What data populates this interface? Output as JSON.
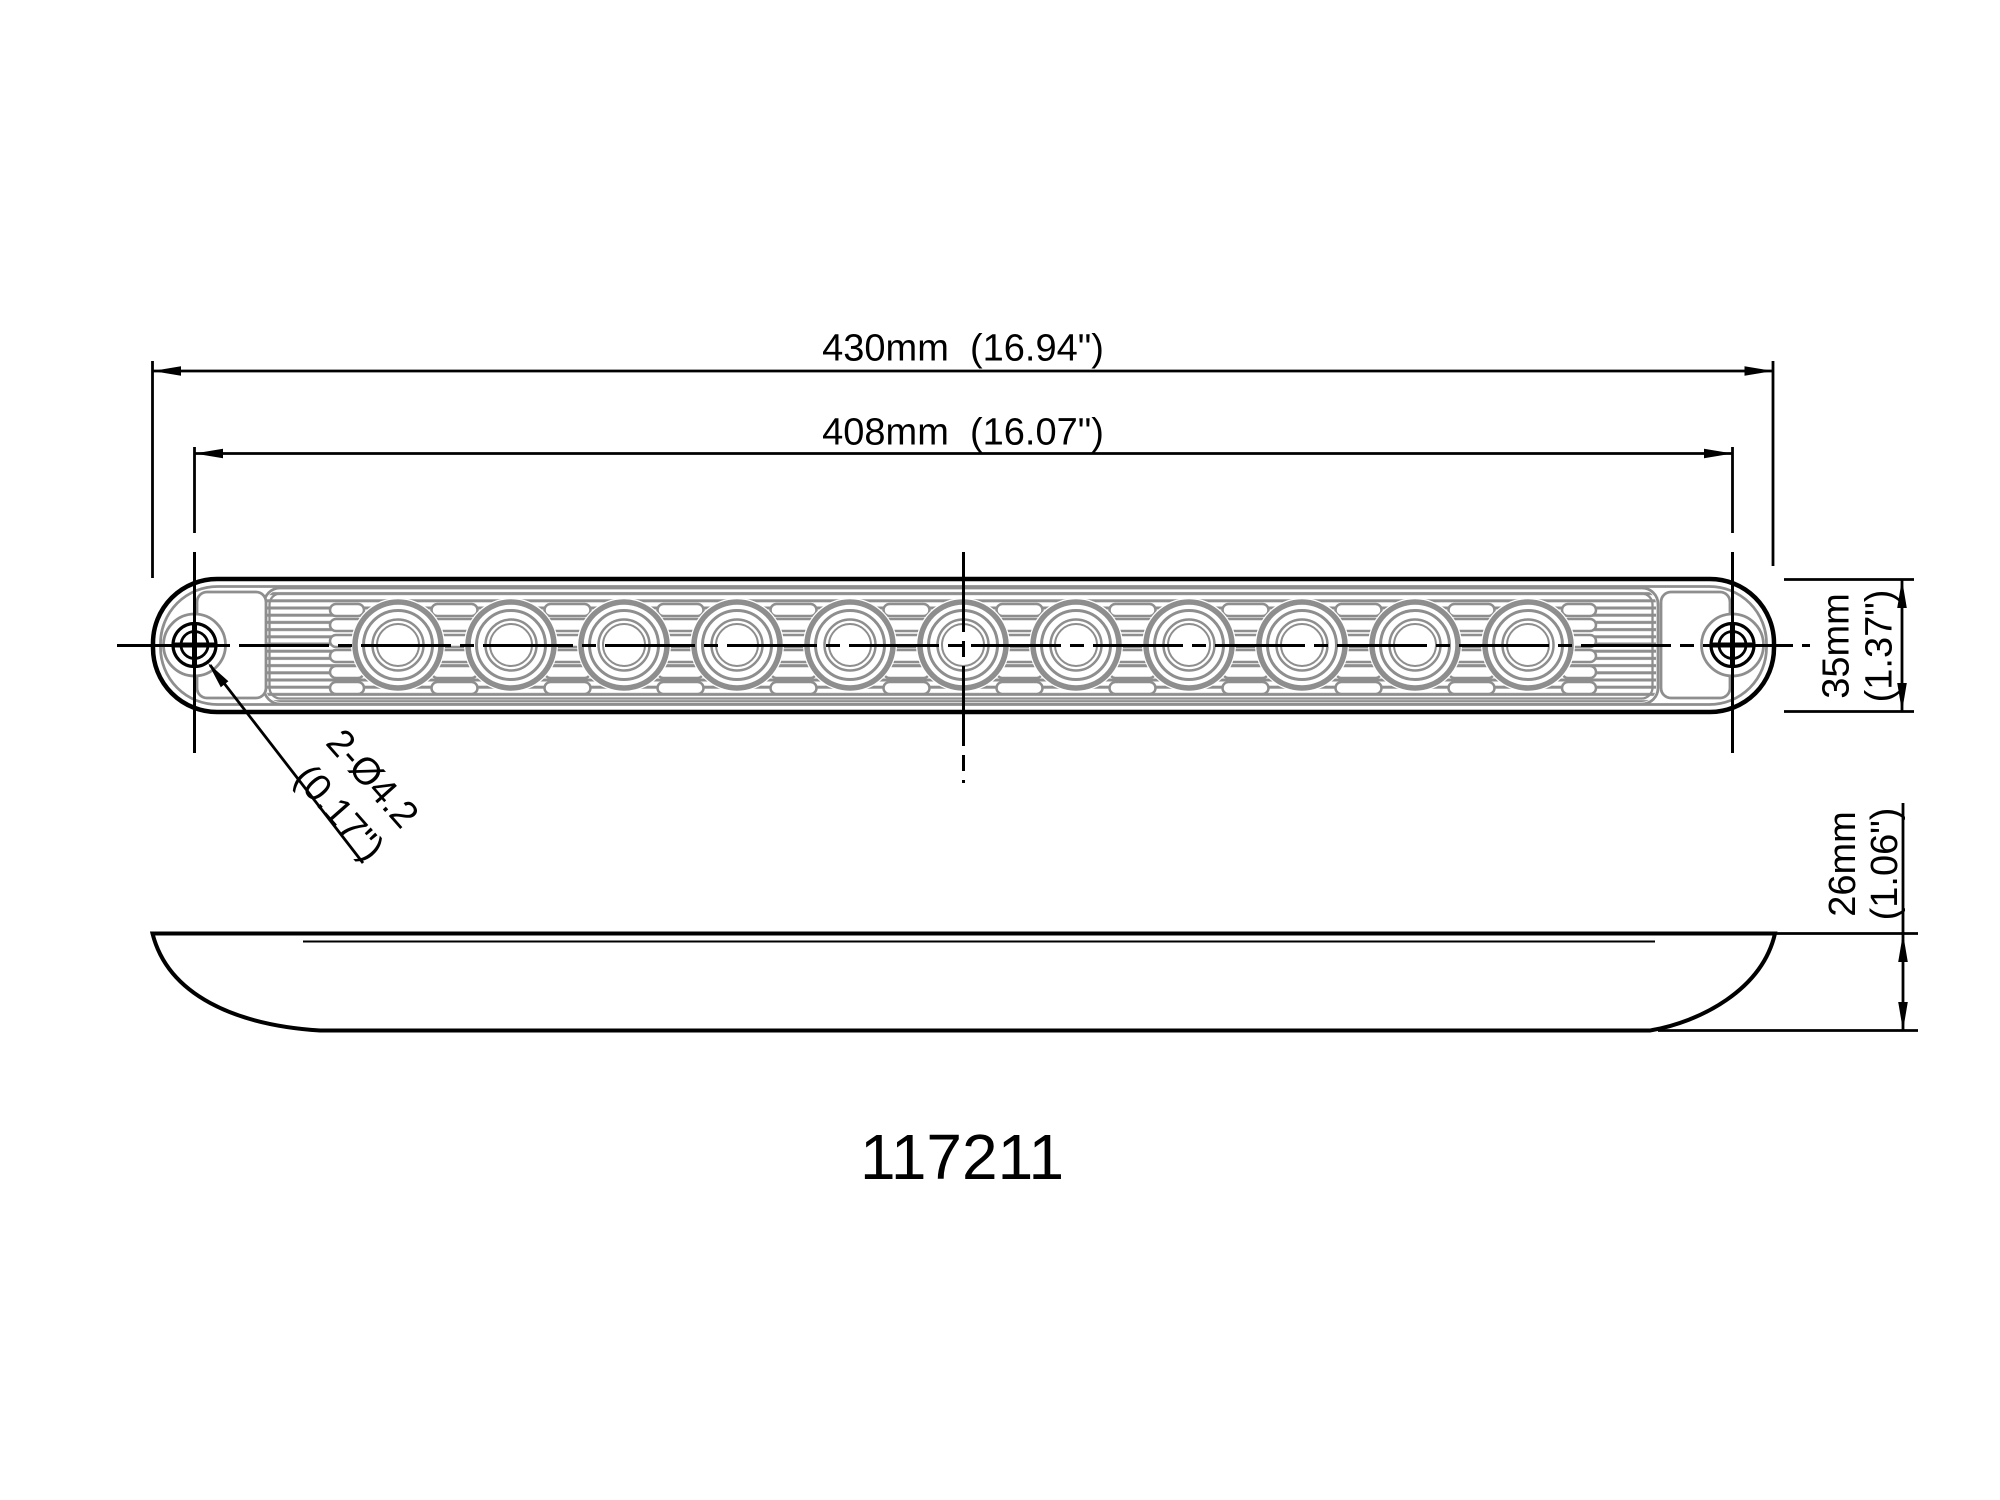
{
  "drawing": {
    "part_number": "117211",
    "labels": {
      "overall_length": "430mm  (16.94\")",
      "mounting_centers": "408mm  (16.07\")",
      "width_mm": "35mm",
      "width_in": "(1.37\")",
      "depth_mm": "26mm",
      "depth_in": "(1.06\")",
      "holes_qty_dia": "2-Ø4.2",
      "holes_dia_in": "(0.17\")"
    },
    "dimensions": [
      {
        "name": "overall-length",
        "value_mm": 430,
        "value_in": 16.94
      },
      {
        "name": "mounting-hole-centers",
        "value_mm": 408,
        "value_in": 16.07
      },
      {
        "name": "width",
        "value_mm": 35,
        "value_in": 1.37
      },
      {
        "name": "depth",
        "value_mm": 26,
        "value_in": 1.06
      },
      {
        "name": "mounting-holes",
        "count": 2,
        "diameter_mm": 4.2,
        "diameter_in": 0.17
      }
    ],
    "led_count": 11,
    "colors": {
      "outline": "#000000",
      "detail_gray": "#8e8e8e",
      "background": "#ffffff"
    }
  }
}
